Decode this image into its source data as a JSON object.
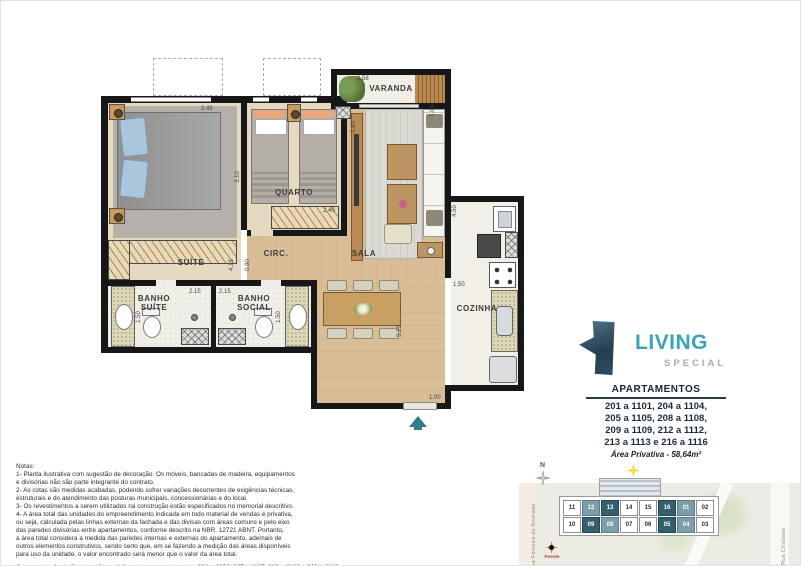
{
  "plan": {
    "rooms": {
      "varanda": "VARANDA",
      "quarto": "QUARTO",
      "suite": "SUÍTE",
      "circ": "CIRC.",
      "sala": "SALA",
      "banho_suite": "BANHO\nSUÍTE",
      "banho_social": "BANHO\nSOCIAL",
      "cozinha": "COZINHA"
    },
    "dims": {
      "suite_top": "2.45",
      "varanda_top": "2.58",
      "varanda_right": "1.03",
      "sala_left": "2.80",
      "quarto_left": "3.10",
      "quarto_right": "2.40",
      "circ_a": "4.15",
      "circ_b": "0.90",
      "banho_suite_top": "2.15",
      "banho_social_top": "2.15",
      "banho_suite_left": "1.50",
      "banho_social_right": "1.50",
      "cozinha_right": "4.50",
      "cozinha_left": "1.50",
      "sala_right": "5.25",
      "entry": "1.00"
    }
  },
  "brand": {
    "name": "LIVING",
    "subtitle": "SPECIAL"
  },
  "apartments": {
    "title": "APARTAMENTOS",
    "lines": [
      "201 a 1101, 204 a 1104,",
      "205 a 1105, 208 a 1108,",
      "209 a 1109, 212 a 1112,",
      "213 a 1113 e 216 a 1116"
    ],
    "area": "Área Privativa - 58,64m²"
  },
  "notes": {
    "lines": [
      "Notas:",
      "1- Planta ilustrativa com sugestão de decoração. Os móveis, bancadas de madeira, equipamentos",
      "e divisórias não são parte integrante do contrato.",
      "2- As cotas são medidas acabadas, podendo sofrer variações decorrentes de exigências técnicas,",
      "estruturais e do atendimento das posturas municipais, concessionárias e do local.",
      "3- Os revestimentos a serem utilizados na construção estão especificados no memorial descritivo.",
      "4- A área total das unidades do empreendimento indicada em todo material de vendas é privativa,",
      "ou seja, calculada pelas linhas externas da fachada e das divisas com áreas comuns e pelo eixo",
      "das paredes divisórias entre apartamentos, conforme descrito na NBR. 12721 ABNT. Portanto,",
      "a área total considera a medida das paredes internas e externas do apartamento, ademais de",
      "outros elementos construtivos, sendo certo que, em se fazendo a medição das áreas disponíveis",
      "para uso da unidade, o valor encontrado será menor que o valor da área total."
    ],
    "bold_lines": [
      "A presente planta ilustra referencialmente os apartamentos 201 a 1101, 205 a 1105, 209 a 1109 e 213 a 1113,",
      "sendo os apartamentos 204 a 1104, 208 a 1108, 212 a 1112 e 216 a 1116 espelhados."
    ]
  },
  "sitemap": {
    "north": "N",
    "streets": {
      "left": "Rua Ferreira de Andrade",
      "right": "Rua Cristiano"
    },
    "sun": {
      "east": "Nascente",
      "west": "Poente"
    },
    "units": [
      {
        "n": "11",
        "hl": ""
      },
      {
        "n": "12",
        "hl": "hl-med"
      },
      {
        "n": "13",
        "hl": "hl-dark"
      },
      {
        "n": "14",
        "hl": ""
      },
      {
        "n": "15",
        "hl": ""
      },
      {
        "n": "16",
        "hl": "hl-dark"
      },
      {
        "n": "01",
        "hl": "hl-med"
      },
      {
        "n": "02",
        "hl": ""
      },
      {
        "n": "10",
        "hl": ""
      },
      {
        "n": "09",
        "hl": "hl-dark"
      },
      {
        "n": "08",
        "hl": "hl-med"
      },
      {
        "n": "07",
        "hl": ""
      },
      {
        "n": "06",
        "hl": ""
      },
      {
        "n": "05",
        "hl": "hl-dark"
      },
      {
        "n": "04",
        "hl": "hl-med"
      },
      {
        "n": "03",
        "hl": ""
      }
    ]
  },
  "colors": {
    "brand_teal": "#3ba3b8",
    "navy": "#152636",
    "highlight_dark": "#33606f",
    "highlight_medium": "#7e9dac",
    "entry_arrow": "#2e7d8c"
  }
}
